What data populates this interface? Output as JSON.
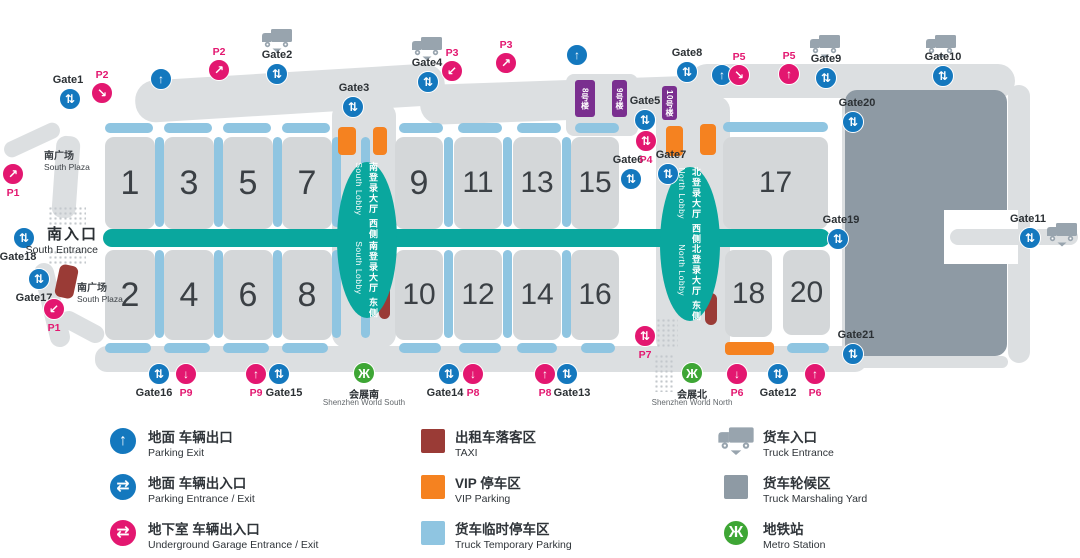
{
  "colors": {
    "blue": "#1478be",
    "pink": "#e31770",
    "teal": "#0aa79e",
    "light_blue": "#8fc5e1",
    "orange": "#f58220",
    "maroon": "#9a3b36",
    "purple": "#7a2f8f",
    "green": "#3ea635",
    "hall_gray": "#d4d7d9",
    "road_gray": "#dcdfe1",
    "yard_gray": "#8e9aa4",
    "truck_gray": "#98a4ae"
  },
  "map": {
    "gate_glyph": "⇅",
    "exit_glyph": "↑",
    "metro_glyph": "Ж",
    "roads": [
      [
        135,
        72,
        310,
        42,
        20,
        -3.5
      ],
      [
        420,
        80,
        300,
        40,
        20,
        -2
      ],
      [
        690,
        64,
        325,
        34,
        17,
        0
      ],
      [
        2,
        132,
        60,
        16,
        8,
        -25
      ],
      [
        54,
        136,
        24,
        82,
        10,
        4
      ],
      [
        42,
        262,
        20,
        86,
        10,
        -14
      ],
      [
        58,
        318,
        48,
        18,
        9,
        28
      ],
      [
        95,
        346,
        772,
        26,
        12,
        0
      ],
      [
        842,
        95,
        24,
        268,
        12,
        0
      ],
      [
        1008,
        85,
        22,
        278,
        11,
        0
      ],
      [
        850,
        356,
        158,
        12,
        6,
        0
      ],
      [
        332,
        102,
        64,
        246,
        14,
        0
      ],
      [
        656,
        96,
        74,
        258,
        14,
        0
      ],
      [
        566,
        74,
        72,
        62,
        8,
        0
      ],
      [
        458,
        86,
        40,
        28,
        4,
        0
      ],
      [
        528,
        86,
        24,
        28,
        4,
        0
      ]
    ],
    "roads_top": [
      [
        950,
        229,
        128,
        16,
        8,
        0
      ]
    ],
    "dots": [
      [
        48,
        206,
        38,
        20
      ],
      [
        48,
        250,
        38,
        14
      ],
      [
        656,
        318,
        22,
        30
      ],
      [
        654,
        354,
        20,
        38
      ]
    ],
    "yard": [
      845,
      90,
      162,
      266
    ],
    "notch": [
      944,
      210,
      74,
      54
    ],
    "halls": [
      {
        "n": "1",
        "x": 105,
        "y": 137,
        "w": 50,
        "h": 92
      },
      {
        "n": "3",
        "x": 164,
        "y": 137,
        "w": 50,
        "h": 92
      },
      {
        "n": "5",
        "x": 223,
        "y": 137,
        "w": 50,
        "h": 92
      },
      {
        "n": "7",
        "x": 282,
        "y": 137,
        "w": 50,
        "h": 92
      },
      {
        "n": "9",
        "x": 395,
        "y": 137,
        "w": 48,
        "h": 92
      },
      {
        "n": "11",
        "x": 454,
        "y": 137,
        "w": 48,
        "h": 92
      },
      {
        "n": "13",
        "x": 513,
        "y": 137,
        "w": 48,
        "h": 92
      },
      {
        "n": "15",
        "x": 571,
        "y": 137,
        "w": 48,
        "h": 92
      },
      {
        "n": "17",
        "x": 723,
        "y": 137,
        "w": 105,
        "h": 92
      },
      {
        "n": "2",
        "x": 105,
        "y": 250,
        "w": 50,
        "h": 90
      },
      {
        "n": "4",
        "x": 164,
        "y": 250,
        "w": 50,
        "h": 90
      },
      {
        "n": "6",
        "x": 223,
        "y": 250,
        "w": 50,
        "h": 90
      },
      {
        "n": "8",
        "x": 282,
        "y": 250,
        "w": 50,
        "h": 90
      },
      {
        "n": "10",
        "x": 395,
        "y": 250,
        "w": 48,
        "h": 90
      },
      {
        "n": "12",
        "x": 454,
        "y": 250,
        "w": 48,
        "h": 90
      },
      {
        "n": "14",
        "x": 513,
        "y": 250,
        "w": 48,
        "h": 90
      },
      {
        "n": "16",
        "x": 571,
        "y": 250,
        "w": 48,
        "h": 90
      },
      {
        "n": "18",
        "x": 725,
        "y": 250,
        "w": 47,
        "h": 87
      },
      {
        "n": "20",
        "x": 783,
        "y": 250,
        "w": 47,
        "h": 85
      }
    ],
    "bars_h": [
      [
        105,
        123,
        48
      ],
      [
        164,
        123,
        48
      ],
      [
        223,
        123,
        48
      ],
      [
        282,
        123,
        48
      ],
      [
        399,
        123,
        44
      ],
      [
        458,
        123,
        44
      ],
      [
        517,
        123,
        44
      ],
      [
        575,
        123,
        44
      ],
      [
        723,
        122,
        105
      ],
      [
        105,
        343,
        46
      ],
      [
        164,
        343,
        46
      ],
      [
        223,
        343,
        46
      ],
      [
        282,
        343,
        46
      ],
      [
        399,
        343,
        42
      ],
      [
        459,
        343,
        42
      ],
      [
        517,
        343,
        40
      ],
      [
        581,
        343,
        34
      ],
      [
        787,
        343,
        42
      ]
    ],
    "bars_v": [
      [
        155,
        137,
        90
      ],
      [
        214,
        137,
        90
      ],
      [
        273,
        137,
        90
      ],
      [
        332,
        137,
        90
      ],
      [
        361,
        137,
        90
      ],
      [
        444,
        137,
        90
      ],
      [
        503,
        137,
        90
      ],
      [
        562,
        137,
        90
      ],
      [
        155,
        250,
        88
      ],
      [
        214,
        250,
        88
      ],
      [
        273,
        250,
        88
      ],
      [
        332,
        250,
        88
      ],
      [
        361,
        250,
        88
      ],
      [
        444,
        250,
        88
      ],
      [
        503,
        250,
        88
      ],
      [
        562,
        250,
        88
      ]
    ],
    "vip": [
      [
        338,
        127,
        18,
        28
      ],
      [
        373,
        127,
        14,
        28
      ],
      [
        666,
        126,
        17,
        30
      ],
      [
        700,
        124,
        16,
        31
      ],
      [
        725,
        342,
        49,
        13
      ]
    ],
    "taxi": [
      [
        57,
        265,
        19,
        33,
        12
      ],
      [
        379,
        286,
        11,
        33,
        0
      ],
      [
        705,
        293,
        12,
        32,
        0
      ]
    ],
    "band": [
      103,
      229,
      727,
      18
    ],
    "lobbies": [
      [
        367,
        240,
        30,
        78
      ],
      [
        690,
        244,
        30,
        77
      ]
    ],
    "lobby_texts": [
      {
        "x": 367,
        "y": 201,
        "zh": "南登录大厅 西侧",
        "en": "South Lobby"
      },
      {
        "x": 367,
        "y": 280,
        "zh": "南登录大厅 东侧",
        "en": "South Lobby"
      },
      {
        "x": 690,
        "y": 206,
        "zh": "北登录大厅 西侧",
        "en": "North Lobby"
      },
      {
        "x": 690,
        "y": 283,
        "zh": "北登录大厅 东侧",
        "en": "North Lobby"
      }
    ],
    "buildings": [
      {
        "t": "8号楼",
        "x": 575,
        "y": 80,
        "w": 20,
        "h": 37
      },
      {
        "t": "9号楼",
        "x": 612,
        "y": 80,
        "w": 15,
        "h": 37
      },
      {
        "t": "10号楼",
        "x": 662,
        "y": 86,
        "w": 15,
        "h": 34
      }
    ],
    "gates": [
      {
        "label": "Gate1",
        "x": 70,
        "y": 99,
        "p": "a",
        "dx": -2
      },
      {
        "label": "Gate2",
        "x": 277,
        "y": 74,
        "p": "a",
        "dx": 0
      },
      {
        "label": "Gate3",
        "x": 353,
        "y": 107,
        "p": "a",
        "dx": 1
      },
      {
        "label": "Gate4",
        "x": 428,
        "y": 82,
        "p": "a",
        "dx": -1
      },
      {
        "label": "Gate5",
        "x": 645,
        "y": 120,
        "p": "a",
        "dx": 0
      },
      {
        "label": "Gate6",
        "x": 631,
        "y": 179,
        "p": "a",
        "dx": -3
      },
      {
        "label": "Gate7",
        "x": 668,
        "y": 174,
        "p": "a",
        "dx": 3
      },
      {
        "label": "Gate8",
        "x": 687,
        "y": 72,
        "p": "a",
        "dx": 0
      },
      {
        "label": "Gate9",
        "x": 826,
        "y": 78,
        "p": "a",
        "dx": 0
      },
      {
        "label": "Gate10",
        "x": 943,
        "y": 76,
        "p": "a",
        "dx": 0
      },
      {
        "label": "Gate11",
        "x": 1030,
        "y": 238,
        "p": "a",
        "dx": -2
      },
      {
        "label": "Gate12",
        "x": 778,
        "y": 374,
        "p": "b",
        "dx": 0
      },
      {
        "label": "Gate13",
        "x": 567,
        "y": 374,
        "p": "b",
        "dx": 5
      },
      {
        "label": "Gate14",
        "x": 449,
        "y": 374,
        "p": "b",
        "dx": -4
      },
      {
        "label": "Gate15",
        "x": 279,
        "y": 374,
        "p": "b",
        "dx": 5
      },
      {
        "label": "Gate16",
        "x": 159,
        "y": 374,
        "p": "b",
        "dx": -5
      },
      {
        "label": "Gate17",
        "x": 39,
        "y": 279,
        "p": "b",
        "dx": -5
      },
      {
        "label": "Gate18",
        "x": 24,
        "y": 238,
        "p": "b",
        "dx": -6
      },
      {
        "label": "Gate19",
        "x": 838,
        "y": 239,
        "p": "a",
        "dx": 3
      },
      {
        "label": "Gate20",
        "x": 853,
        "y": 122,
        "p": "a",
        "dx": 4
      },
      {
        "label": "Gate21",
        "x": 853,
        "y": 354,
        "p": "a",
        "dx": 3
      }
    ],
    "exits": [
      [
        161,
        79
      ],
      [
        577,
        55
      ],
      [
        722,
        75
      ]
    ],
    "pmarks": [
      {
        "label": "P1",
        "x": 13,
        "y": 174,
        "g": "↗",
        "p": "b"
      },
      {
        "label": "P1",
        "x": 54,
        "y": 309,
        "g": "↙",
        "p": "b"
      },
      {
        "label": "P2",
        "x": 102,
        "y": 93,
        "g": "↘",
        "p": "a"
      },
      {
        "label": "P2",
        "x": 219,
        "y": 70,
        "g": "↗",
        "p": "a"
      },
      {
        "label": "P3",
        "x": 452,
        "y": 71,
        "g": "↙",
        "p": "a"
      },
      {
        "label": "P3",
        "x": 506,
        "y": 63,
        "g": "↗",
        "p": "a"
      },
      {
        "label": "P4",
        "x": 646,
        "y": 141,
        "g": "⇅",
        "p": "b"
      },
      {
        "label": "P5",
        "x": 739,
        "y": 75,
        "g": "↘",
        "p": "a"
      },
      {
        "label": "P5",
        "x": 789,
        "y": 74,
        "g": "↑",
        "p": "a"
      },
      {
        "label": "P6",
        "x": 737,
        "y": 374,
        "g": "↓",
        "p": "b"
      },
      {
        "label": "P6",
        "x": 815,
        "y": 374,
        "g": "↑",
        "p": "b"
      },
      {
        "label": "P7",
        "x": 645,
        "y": 336,
        "g": "⇅",
        "p": "b"
      },
      {
        "label": "P8",
        "x": 473,
        "y": 374,
        "g": "↓",
        "p": "b"
      },
      {
        "label": "P8",
        "x": 545,
        "y": 374,
        "g": "↑",
        "p": "b"
      },
      {
        "label": "P9",
        "x": 186,
        "y": 374,
        "g": "↓",
        "p": "b"
      },
      {
        "label": "P9",
        "x": 256,
        "y": 374,
        "g": "↑",
        "p": "b"
      }
    ],
    "trucks": [
      [
        277,
        28
      ],
      [
        427,
        36
      ],
      [
        825,
        34
      ],
      [
        941,
        34
      ],
      [
        1062,
        222
      ]
    ],
    "metros": [
      {
        "x": 364,
        "y": 373,
        "zh": "会展南",
        "en": "Shenzhen World South"
      },
      {
        "x": 692,
        "y": 373,
        "zh": "会展北",
        "en": "Shenzhen World North"
      }
    ],
    "plazas": [
      {
        "x": 44,
        "y": 147,
        "zh": "南广场",
        "en": "South Plaza"
      },
      {
        "x": 77,
        "y": 279,
        "zh": "南广场",
        "en": "South Plaza"
      }
    ],
    "entrance": {
      "zh": "南入口",
      "en": "South Entrance",
      "x": 18,
      "y": 223,
      "w": 80
    }
  },
  "legend": {
    "glyphs": {
      "parking-exit": "↑",
      "parking-entrance-exit": "⇄",
      "underground-garage": "⇄",
      "metro": "Ж"
    },
    "columns": [
      {
        "items": [
          {
            "icon": "parking-exit",
            "zh": "地面 车辆出口",
            "en": "Parking Exit"
          },
          {
            "icon": "parking-entrance-exit",
            "zh": "地面 车辆出入口",
            "en": "Parking Entrance / Exit"
          },
          {
            "icon": "underground-garage",
            "zh": "地下室 车辆出入口",
            "en": "Underground Garage Entrance / Exit"
          }
        ]
      },
      {
        "items": [
          {
            "icon": "taxi",
            "zh": "出租车落客区",
            "en": "TAXI"
          },
          {
            "icon": "vip",
            "zh": "VIP 停车区",
            "en": "VIP Parking"
          },
          {
            "icon": "truck-temp",
            "zh": "货车临时停车区",
            "en": "Truck Temporary Parking"
          }
        ]
      },
      {
        "items": [
          {
            "icon": "truck",
            "zh": "货车入口",
            "en": "Truck Entrance"
          },
          {
            "icon": "marshaling",
            "zh": "货车轮候区",
            "en": "Truck Marshaling Yard"
          },
          {
            "icon": "metro",
            "zh": "地铁站",
            "en": "Metro Station"
          }
        ]
      }
    ]
  }
}
